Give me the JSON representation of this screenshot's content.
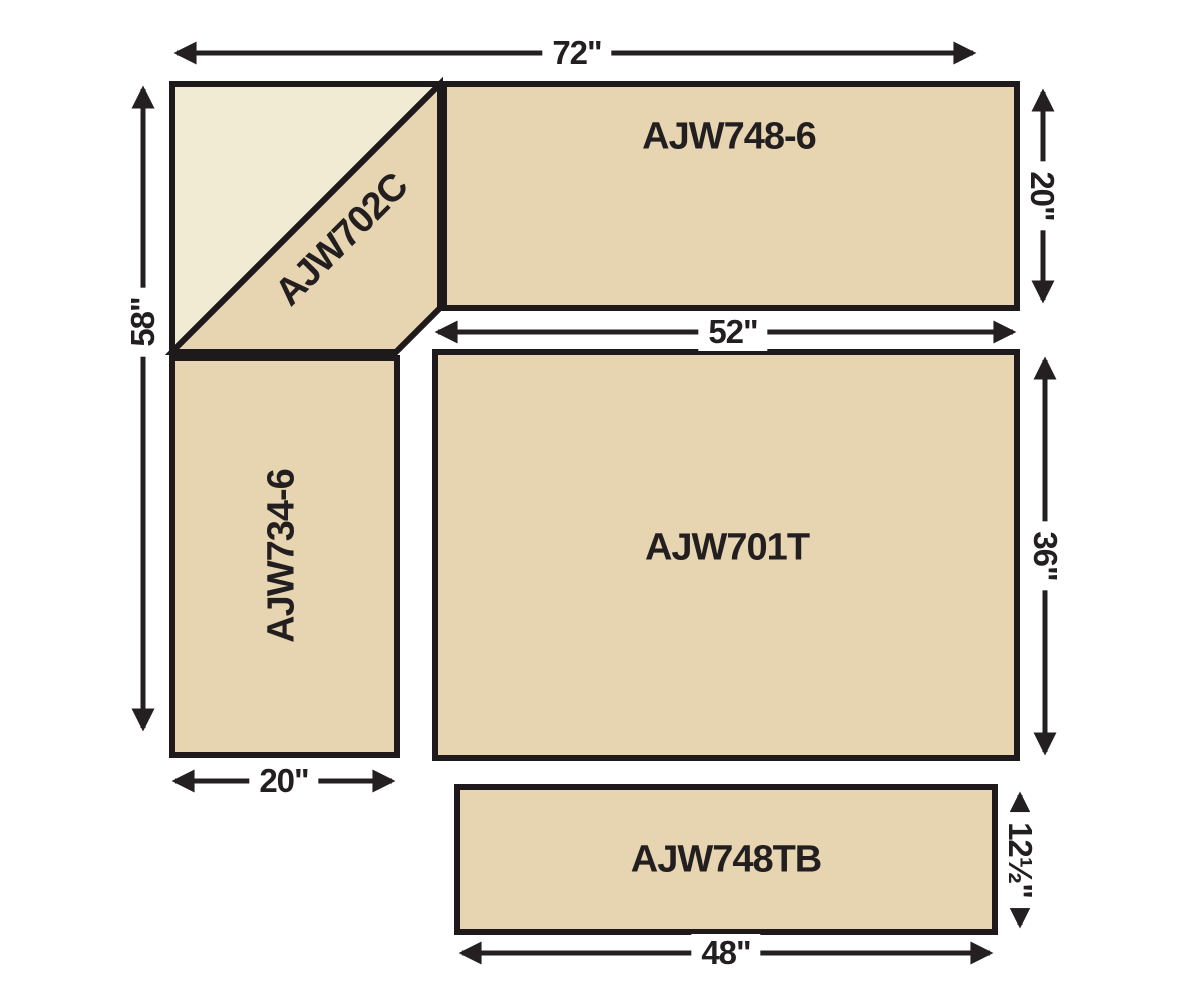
{
  "pieces": {
    "corner": {
      "label": "AJW702C"
    },
    "top_bench": {
      "label": "AJW748-6"
    },
    "left_bench": {
      "label": "AJW734-6"
    },
    "table": {
      "label": "AJW701T"
    },
    "bottom_bench": {
      "label": "AJW748TB"
    }
  },
  "dimensions": {
    "overall_width": {
      "label": "72\""
    },
    "overall_height": {
      "label": "58\""
    },
    "top_bench_depth": {
      "label": "20\""
    },
    "table_width": {
      "label": "52\""
    },
    "table_depth": {
      "label": "36\""
    },
    "left_bench_width": {
      "label": "20\""
    },
    "bottom_bench_depth": {
      "label": "12½\""
    },
    "bottom_bench_width": {
      "label": "48\""
    }
  },
  "colors": {
    "cream": "#f2ebd4",
    "tan": "#e6d5b0",
    "outline": "#1e1a1b"
  }
}
